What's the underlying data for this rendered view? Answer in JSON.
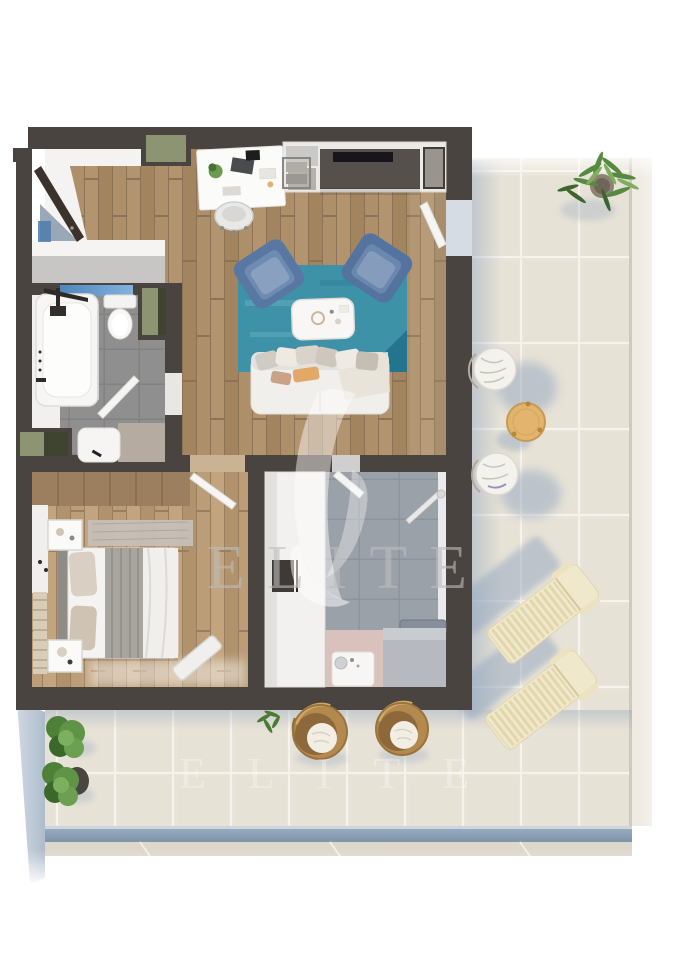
{
  "watermark": {
    "text": "ELITE",
    "secondary_text": "ELITE"
  },
  "palette": {
    "canvas": "#ffffff",
    "wall": "#4a4440",
    "wood": "#a98b67",
    "wood2": "#b99b77",
    "bath_tile": "#8f8f8f",
    "shower_tile": "#9aa0a8",
    "terrace_tile": "#e9e4da",
    "railing": "#8296ab",
    "bevel": "#c9d4de",
    "rug": "#3e92a7",
    "rug_dark": "#1f7089",
    "armchair": "#5878a3",
    "sofa": "#f1efec",
    "accent_blue": "#5c8fc2",
    "olive": "#8d9471",
    "olive_dark": "#3e442f",
    "entry_door": "#3a322b",
    "shadow": "#92a6bf",
    "watermark": "#bdbdbd",
    "lounger": "#f0e8ca",
    "rattan": "#b4894d",
    "plant": "#578a41",
    "plant_dark": "#3c662c",
    "table_wood": "#e3b46d",
    "sink_pink": "#d8c2bb"
  }
}
